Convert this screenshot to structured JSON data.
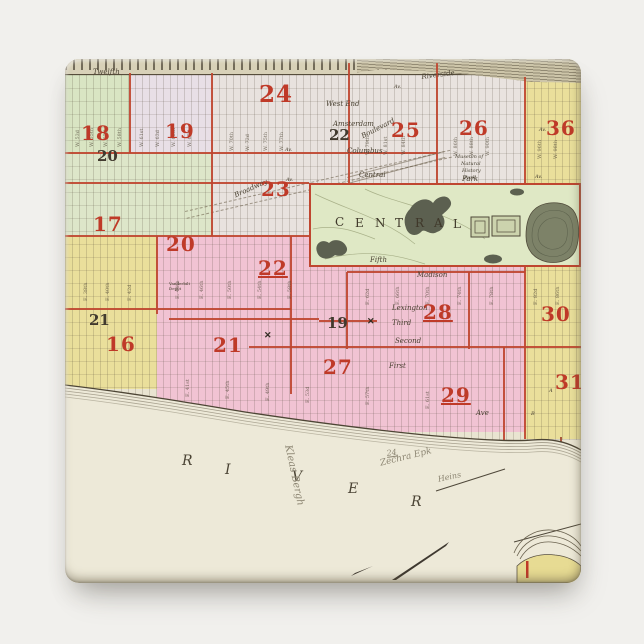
{
  "scene": {
    "background": "#f1f0ed"
  },
  "magnet": {
    "base_color": "#ebe6d4",
    "shape": "square-rounded"
  },
  "map": {
    "colors": {
      "cream": "#ebe6d4",
      "green": "#d9e5c3",
      "pale_green": "#dde6c9",
      "lavender": "#e8dfe6",
      "pale": "#e8e2de",
      "yellow": "#eadf9b",
      "pink": "#f1c3d3",
      "park_green": "#dfe8c5",
      "red_line": "#bf4630",
      "red_number": "#bf3a28",
      "ink": "#413a2e",
      "pencil": "#8d8673"
    },
    "regions": [
      {
        "x": 0,
        "y": 12,
        "w": 516,
        "h": 380,
        "bg": "#e9e4d1"
      },
      {
        "x": 147,
        "y": 14,
        "w": 137,
        "h": 163,
        "bg": "#e8e2de"
      },
      {
        "x": 284,
        "y": 14,
        "w": 176,
        "h": 110,
        "bg": "#e9e3df"
      },
      {
        "x": 64,
        "y": 14,
        "w": 83,
        "h": 80,
        "bg": "#e8dfe6"
      },
      {
        "x": 0,
        "y": 14,
        "w": 64,
        "h": 80,
        "bg": "#d9e5c3"
      },
      {
        "x": 0,
        "y": 94,
        "w": 147,
        "h": 83,
        "bg": "#dde6c9"
      },
      {
        "x": 460,
        "y": 22,
        "w": 56,
        "h": 102,
        "bg": "#eadf9b"
      },
      {
        "x": 0,
        "y": 177,
        "w": 92,
        "h": 153,
        "bg": "#eadf9b"
      },
      {
        "x": 92,
        "y": 177,
        "w": 368,
        "h": 196,
        "bg": "#f1c3d3"
      },
      {
        "x": 460,
        "y": 124,
        "w": 56,
        "h": 256,
        "bg": "#eadf9b"
      }
    ],
    "red_lines": [
      {
        "x": 64,
        "y": 14,
        "w": 2,
        "h": 80
      },
      {
        "x": 146,
        "y": 14,
        "w": 2,
        "h": 163
      },
      {
        "x": 283,
        "y": 4,
        "w": 2,
        "h": 120
      },
      {
        "x": 371,
        "y": 4,
        "w": 2,
        "h": 120
      },
      {
        "x": 459,
        "y": 18,
        "w": 2,
        "h": 106
      },
      {
        "x": 91,
        "y": 177,
        "w": 2,
        "h": 78
      },
      {
        "x": 225,
        "y": 177,
        "w": 2,
        "h": 158
      },
      {
        "x": 281,
        "y": 213,
        "w": 2,
        "h": 77
      },
      {
        "x": 403,
        "y": 213,
        "w": 2,
        "h": 77
      },
      {
        "x": 459,
        "y": 208,
        "w": 2,
        "h": 172
      },
      {
        "x": 438,
        "y": 288,
        "w": 2,
        "h": 100
      },
      {
        "x": 0,
        "y": 93,
        "w": 372,
        "h": 2
      },
      {
        "x": 0,
        "y": 123,
        "w": 244,
        "h": 2
      },
      {
        "x": 0,
        "y": 176,
        "w": 245,
        "h": 2
      },
      {
        "x": 0,
        "y": 249,
        "w": 226,
        "h": 2
      },
      {
        "x": 104,
        "y": 259,
        "w": 150,
        "h": 2
      },
      {
        "x": 184,
        "y": 287,
        "w": 332,
        "h": 2
      },
      {
        "x": 254,
        "y": 261,
        "w": 58,
        "h": 2
      },
      {
        "x": 282,
        "y": 212,
        "w": 178,
        "h": 2
      },
      {
        "x": 495,
        "y": 378,
        "w": 2,
        "h": 42,
        "bg": "#a34e33"
      }
    ],
    "districts_red": [
      {
        "t": "18",
        "x": 16,
        "y": 62
      },
      {
        "t": "19",
        "x": 100,
        "y": 60
      },
      {
        "t": "24",
        "x": 194,
        "y": 22,
        "size": 23
      },
      {
        "t": "25",
        "x": 326,
        "y": 59
      },
      {
        "t": "26",
        "x": 394,
        "y": 57
      },
      {
        "t": "36",
        "x": 481,
        "y": 57
      },
      {
        "t": "23",
        "x": 196,
        "y": 118
      },
      {
        "t": "17",
        "x": 28,
        "y": 153
      },
      {
        "t": "20",
        "x": 101,
        "y": 173
      },
      {
        "t": "22",
        "x": 193,
        "y": 197,
        "u": true
      },
      {
        "t": "28",
        "x": 358,
        "y": 241,
        "u": true
      },
      {
        "t": "30",
        "x": 476,
        "y": 243
      },
      {
        "t": "16",
        "x": 41,
        "y": 273
      },
      {
        "t": "21",
        "x": 148,
        "y": 274
      },
      {
        "t": "27",
        "x": 258,
        "y": 296
      },
      {
        "t": "29",
        "x": 376,
        "y": 324,
        "u": true
      },
      {
        "t": "31",
        "x": 490,
        "y": 311
      }
    ],
    "wards_black": [
      {
        "t": "20",
        "x": 32,
        "y": 88
      },
      {
        "t": "22",
        "x": 264,
        "y": 67
      },
      {
        "t": "21",
        "x": 24,
        "y": 252
      },
      {
        "t": "19",
        "x": 262,
        "y": 255
      }
    ],
    "streets": [
      {
        "t": "Twelfth",
        "x": 28,
        "y": 9
      },
      {
        "t": "West End",
        "x": 261,
        "y": 41
      },
      {
        "t": "Amsterdam",
        "x": 268,
        "y": 61
      },
      {
        "t": "Boulevard",
        "x": 295,
        "y": 74,
        "rot": -27
      },
      {
        "t": "Columbus",
        "x": 282,
        "y": 88
      },
      {
        "t": "Riverside",
        "x": 356,
        "y": 14,
        "rot": -7
      },
      {
        "t": "Broadway",
        "x": 168,
        "y": 133,
        "rot": -24
      },
      {
        "t": "Central",
        "x": 294,
        "y": 112
      },
      {
        "t": "Park",
        "x": 397,
        "y": 116
      },
      {
        "t": "Fifth",
        "x": 305,
        "y": 197
      },
      {
        "t": "Madison",
        "x": 352,
        "y": 212
      },
      {
        "t": "Lexington",
        "x": 327,
        "y": 245
      },
      {
        "t": "Third",
        "x": 327,
        "y": 260
      },
      {
        "t": "Second",
        "x": 330,
        "y": 278
      },
      {
        "t": "First",
        "x": 324,
        "y": 303
      },
      {
        "t": "Ave",
        "x": 411,
        "y": 350
      },
      {
        "t": "A",
        "x": 484,
        "y": 329,
        "size": 5
      },
      {
        "t": "B",
        "x": 466,
        "y": 352,
        "size": 5
      },
      {
        "t": "Av.",
        "x": 219,
        "y": 34,
        "size": 5
      },
      {
        "t": "Av.",
        "x": 329,
        "y": 25,
        "size": 5
      },
      {
        "t": "Av.",
        "x": 220,
        "y": 88,
        "size": 5
      },
      {
        "t": "Av.",
        "x": 221,
        "y": 118,
        "size": 5
      },
      {
        "t": "Av.",
        "x": 474,
        "y": 68,
        "size": 5
      },
      {
        "t": "Av.",
        "x": 470,
        "y": 115,
        "size": 5
      }
    ],
    "street_numbers": [
      {
        "t": "W. 53d",
        "x": 10,
        "y": 88
      },
      {
        "t": "W. 55th",
        "x": 24,
        "y": 88
      },
      {
        "t": "W. 57th",
        "x": 38,
        "y": 88
      },
      {
        "t": "W. 58th",
        "x": 52,
        "y": 88
      },
      {
        "t": "W. 61st",
        "x": 74,
        "y": 88
      },
      {
        "t": "W. 63d",
        "x": 90,
        "y": 88
      },
      {
        "t": "W. 65th",
        "x": 106,
        "y": 88
      },
      {
        "t": "W. 67th",
        "x": 122,
        "y": 88
      },
      {
        "t": "W. 70th",
        "x": 164,
        "y": 92
      },
      {
        "t": "W. 72d",
        "x": 180,
        "y": 92
      },
      {
        "t": "W. 75th",
        "x": 198,
        "y": 92
      },
      {
        "t": "W. 77th",
        "x": 214,
        "y": 92
      },
      {
        "t": "W. 79th",
        "x": 300,
        "y": 96
      },
      {
        "t": "W. 81st",
        "x": 318,
        "y": 96
      },
      {
        "t": "W. 84th",
        "x": 336,
        "y": 96
      },
      {
        "t": "W. 86th",
        "x": 388,
        "y": 97
      },
      {
        "t": "W. 88th",
        "x": 404,
        "y": 97
      },
      {
        "t": "W. 90th",
        "x": 420,
        "y": 97
      },
      {
        "t": "W. 96th",
        "x": 472,
        "y": 100
      },
      {
        "t": "W. 98th",
        "x": 488,
        "y": 100
      },
      {
        "t": "E. 38th",
        "x": 18,
        "y": 242
      },
      {
        "t": "E. 40th",
        "x": 40,
        "y": 242
      },
      {
        "t": "E. 42d",
        "x": 62,
        "y": 242
      },
      {
        "t": "E. 44th",
        "x": 110,
        "y": 240
      },
      {
        "t": "E. 46th",
        "x": 134,
        "y": 240
      },
      {
        "t": "E. 50th",
        "x": 162,
        "y": 240
      },
      {
        "t": "E. 54th",
        "x": 192,
        "y": 240
      },
      {
        "t": "E. 58th",
        "x": 222,
        "y": 240
      },
      {
        "t": "E. 62d",
        "x": 300,
        "y": 246
      },
      {
        "t": "E. 66th",
        "x": 330,
        "y": 246
      },
      {
        "t": "E. 70th",
        "x": 360,
        "y": 246
      },
      {
        "t": "E. 74th",
        "x": 392,
        "y": 246
      },
      {
        "t": "E. 78th",
        "x": 424,
        "y": 246
      },
      {
        "t": "E. 82d",
        "x": 468,
        "y": 246
      },
      {
        "t": "E. 86th",
        "x": 490,
        "y": 246
      },
      {
        "t": "E. 41st",
        "x": 120,
        "y": 338
      },
      {
        "t": "E. 45th",
        "x": 160,
        "y": 340
      },
      {
        "t": "E. 49th",
        "x": 200,
        "y": 342
      },
      {
        "t": "E. 53d",
        "x": 240,
        "y": 344
      },
      {
        "t": "E. 57th",
        "x": 300,
        "y": 346
      },
      {
        "t": "E. 61st",
        "x": 360,
        "y": 350
      }
    ],
    "central_letters": [
      {
        "t": "C",
        "x": 270,
        "y": 156
      },
      {
        "t": "E",
        "x": 290,
        "y": 157
      },
      {
        "t": "N",
        "x": 310,
        "y": 157
      },
      {
        "t": "T",
        "x": 330,
        "y": 157
      },
      {
        "t": "R",
        "x": 350,
        "y": 157
      },
      {
        "t": "A",
        "x": 369,
        "y": 157
      },
      {
        "t": "L",
        "x": 388,
        "y": 158
      }
    ],
    "museum_lines": [
      {
        "t": "Museum of",
        "x": 390,
        "y": 95
      },
      {
        "t": "Natural",
        "x": 396,
        "y": 102
      },
      {
        "t": "History",
        "x": 397,
        "y": 109
      },
      {
        "t": "Park",
        "x": 399,
        "y": 116
      }
    ],
    "river_letters": [
      {
        "t": "R",
        "x": 117,
        "y": 394
      },
      {
        "t": "I",
        "x": 160,
        "y": 403
      },
      {
        "t": "V",
        "x": 227,
        "y": 410
      },
      {
        "t": "E",
        "x": 283,
        "y": 422
      },
      {
        "t": "R",
        "x": 346,
        "y": 435
      }
    ],
    "annotations": [
      {
        "t": "Kleas Bergh",
        "x": 228,
        "y": 385,
        "rot": 78,
        "size": 10
      },
      {
        "t": "24",
        "x": 321,
        "y": 390,
        "rot": -8,
        "size": 8,
        "u": true
      },
      {
        "t": "Zechra Epk",
        "x": 314,
        "y": 400,
        "rot": -14,
        "size": 9
      },
      {
        "t": "Heins",
        "x": 372,
        "y": 416,
        "rot": -12,
        "size": 8
      }
    ],
    "x_marks": [
      {
        "t": "✕",
        "x": 199,
        "y": 272
      },
      {
        "t": "✕",
        "x": 302,
        "y": 258
      }
    ],
    "micro": {
      "line1": "Vanderbilt",
      "line2": "Depot"
    }
  }
}
